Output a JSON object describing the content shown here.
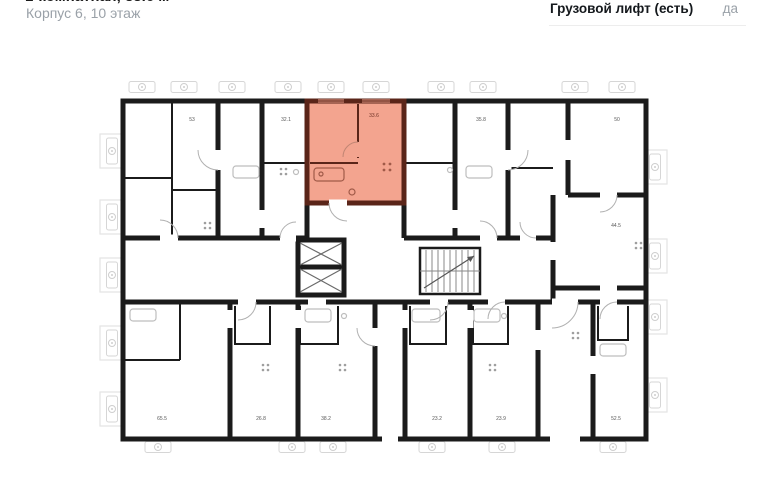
{
  "header": {
    "title_clipped": "1-комнатная, 33.6 м²",
    "subtitle": "Корпус 6, 10 этаж"
  },
  "spec_row": {
    "label": "Грузовой лифт (есть)",
    "value": "да"
  },
  "floorplan": {
    "selected_unit": {
      "area_label": "33.6",
      "fill": "#f3a48f",
      "wall_color": "#5a2519"
    },
    "unit_labels": [
      {
        "id": "unit-53",
        "label": "53"
      },
      {
        "id": "unit-32-1",
        "label": "32.1"
      },
      {
        "id": "unit-35-8",
        "label": "35.8"
      },
      {
        "id": "unit-50",
        "label": "50"
      },
      {
        "id": "unit-44-5",
        "label": "44.5"
      },
      {
        "id": "unit-65-5",
        "label": "65.5"
      },
      {
        "id": "unit-26-8",
        "label": "26.8"
      },
      {
        "id": "unit-38-2",
        "label": "38.2"
      },
      {
        "id": "unit-23-2",
        "label": "23.2"
      },
      {
        "id": "unit-23-9",
        "label": "23.9"
      },
      {
        "id": "unit-52-5",
        "label": "52.5"
      }
    ],
    "colors": {
      "wall": "#1b1b1b",
      "fixture": "#bdbdbd",
      "window_outline": "#d6d6d6",
      "balcony_outline": "#e3e3e3",
      "door_arc": "#b0b0b0",
      "label_text": "#575757"
    }
  }
}
